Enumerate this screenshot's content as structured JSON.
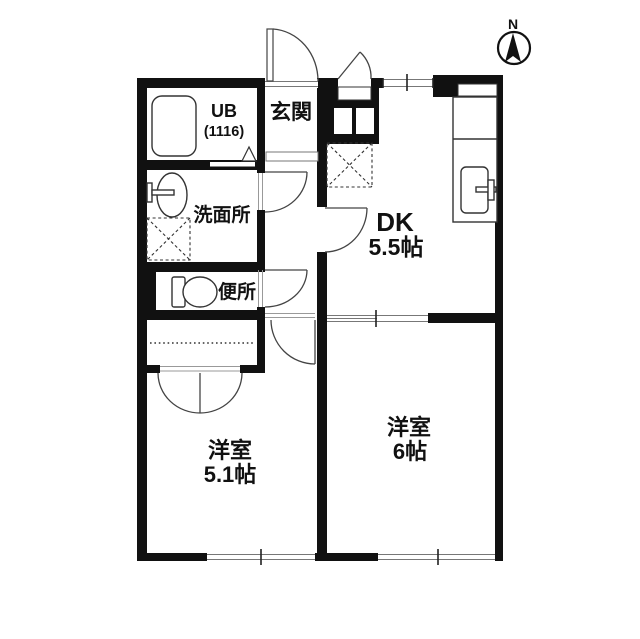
{
  "title": "apartment-floor-plan",
  "compass": {
    "label": "N"
  },
  "rooms": {
    "ub": {
      "label": "UB",
      "size": "(1116)"
    },
    "genkan": {
      "label": "玄関"
    },
    "senmenjo": {
      "label": "洗面所"
    },
    "benjo": {
      "label": "便所"
    },
    "dk": {
      "label": "DK",
      "size": "5.5帖"
    },
    "yoshitsu6": {
      "label": "洋室",
      "size": "6帖"
    },
    "yoshitsu51": {
      "label": "洋室",
      "size": "5.1帖"
    }
  },
  "fixtures": [
    "bathtub-icon",
    "washbasin-icon",
    "toilet-icon",
    "kitchen-counter-icon",
    "kitchen-sink-icon",
    "refrigerator-space-icon",
    "washing-machine-space-icon",
    "closet-icon",
    "shoe-cabinet-icon",
    "north-arrow-icon"
  ],
  "colors": {
    "wall": "#111111",
    "line": "#333333",
    "background": "#ffffff"
  }
}
